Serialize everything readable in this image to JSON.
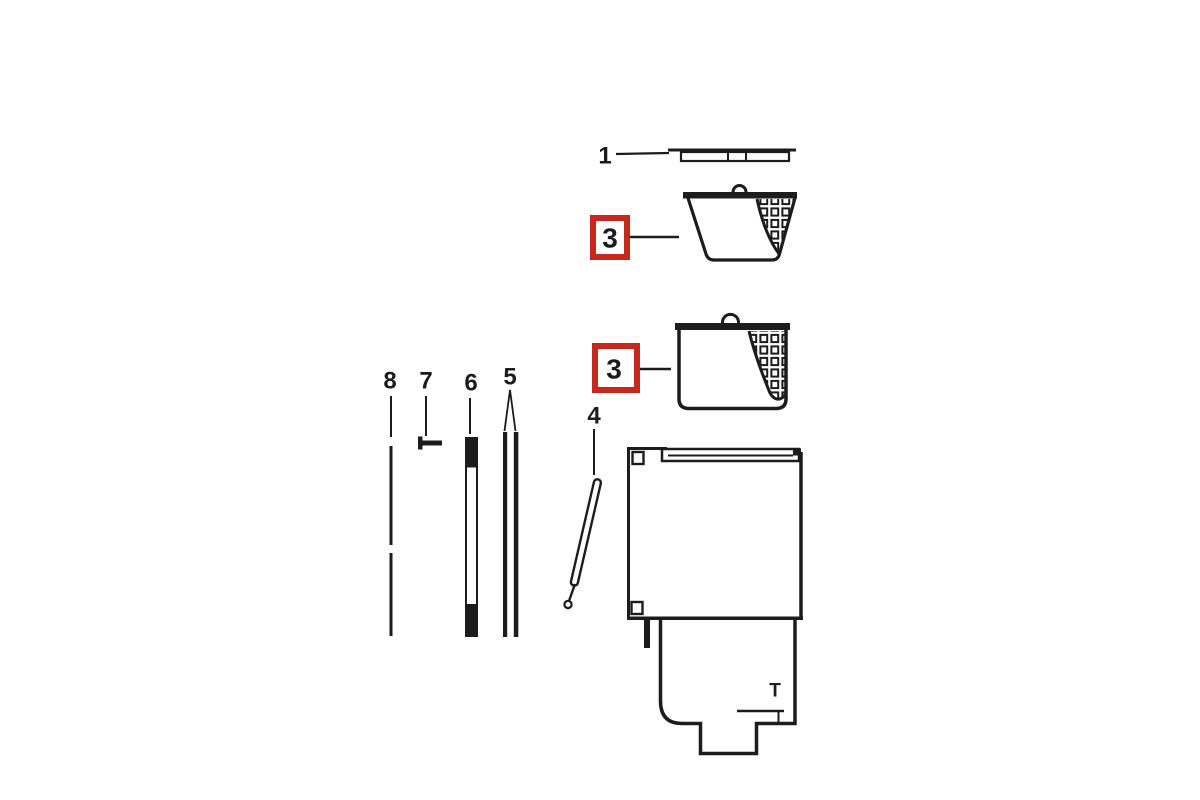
{
  "diagram": {
    "description": "exploded-parts-line-drawing",
    "background_color": "#ffffff",
    "ink_color": "#1c1c1c",
    "highlight_color": "#c5281c",
    "labels": {
      "lid": "1",
      "basket_top": "3",
      "basket_bottom": "3",
      "handle": "4",
      "rod_pair": "5",
      "tube": "6",
      "pin": "7",
      "rod": "8",
      "throat": "T"
    }
  }
}
